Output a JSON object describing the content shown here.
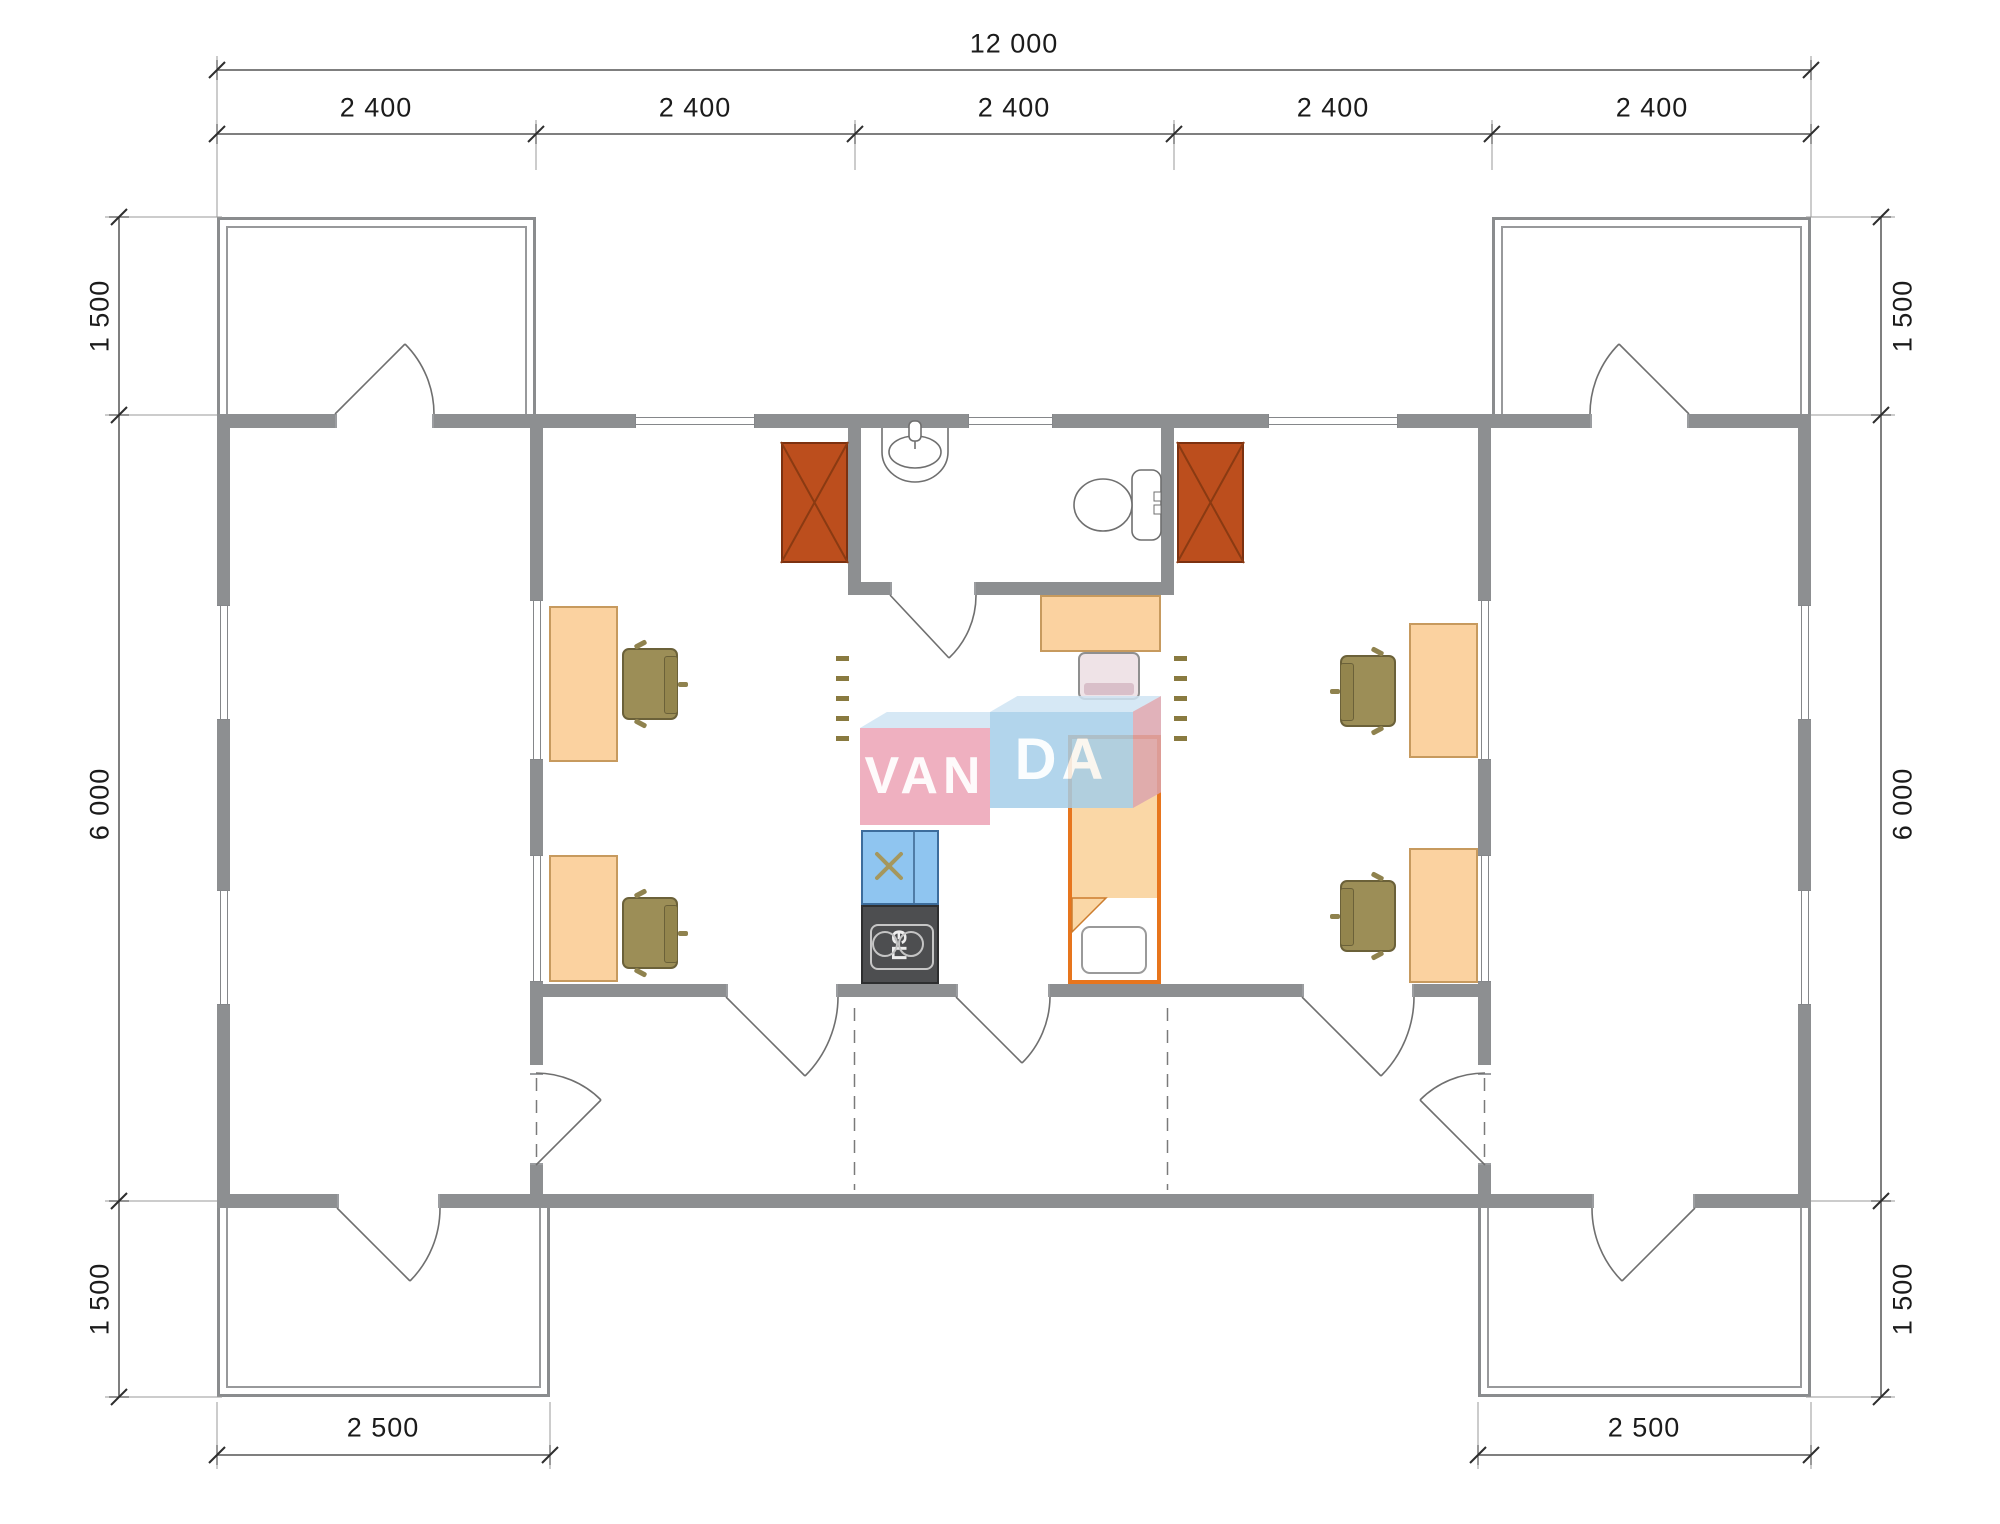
{
  "watermark": {
    "left": "VAN",
    "right": "DA"
  },
  "dimensions": {
    "total_width": "12 000",
    "modules": [
      "2 400",
      "2 400",
      "2 400",
      "2 400",
      "2 400"
    ],
    "left_side": [
      "1 500",
      "6 000",
      "1 500"
    ],
    "right_side": [
      "1 500",
      "6 000",
      "1 500"
    ],
    "bottom": [
      "2 500",
      "2 500"
    ]
  },
  "fixtures": {
    "electric_stove_label": "ПЭ"
  },
  "colors": {
    "wall": "#8D8F91",
    "stove_red": "#BC4E1D",
    "desk": "#FBD2A0",
    "chair_olive": "#9C8E57",
    "kitchen_counter_blue": "#8FC5F0",
    "electric_stove_dark": "#4D4E50",
    "bed_frame_orange": "#E7751D",
    "bed_fill": "#FAD7A6",
    "watermark_pink": "#ECA2B5",
    "watermark_blue": "#A4CEE9"
  }
}
